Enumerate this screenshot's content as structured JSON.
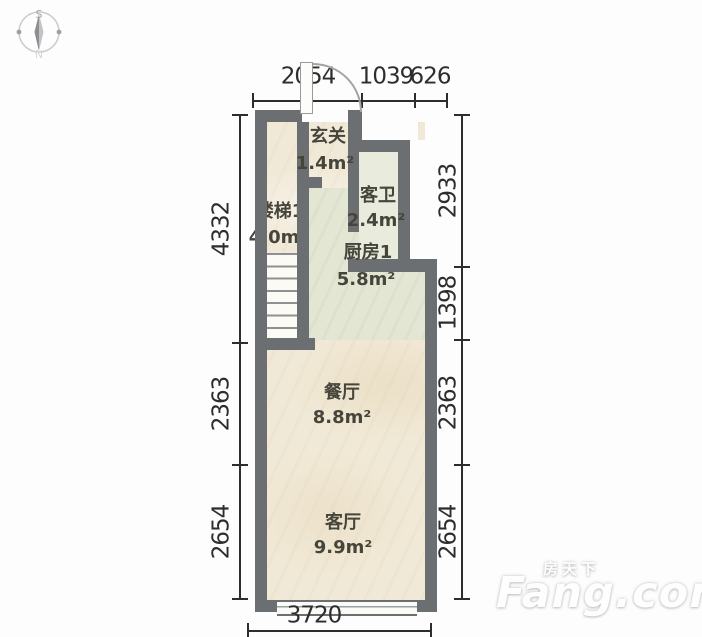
{
  "compass": {
    "south": "S",
    "north": "N"
  },
  "dimensions": {
    "top": [
      "2054",
      "1039",
      "626"
    ],
    "left": [
      "4332",
      "2363",
      "2654"
    ],
    "right": [
      "2933",
      "1398",
      "2363",
      "2654"
    ],
    "bottom": [
      "3720"
    ]
  },
  "rooms": {
    "entry": {
      "name": "玄关",
      "area": "1.4m²"
    },
    "stairs": {
      "name": "楼梯1",
      "area": "4.0m²"
    },
    "bath": {
      "name": "客卫",
      "area": "2.4m²"
    },
    "kitchen": {
      "name": "厨房1",
      "area": "5.8m²"
    },
    "dining": {
      "name": "餐厅",
      "area": "8.8m²"
    },
    "living": {
      "name": "客厅",
      "area": "9.9m²"
    }
  },
  "watermark": {
    "brand_cn": "房天下",
    "brand_en": "Fang.com"
  },
  "colors": {
    "wall": "#6c6f71",
    "floor": "#f1e9d7",
    "kitchen_floor": "#e3e6d3",
    "bath_floor": "#e9ebdc",
    "dimension_text": "#2d2d2d",
    "room_text": "#45453c"
  }
}
